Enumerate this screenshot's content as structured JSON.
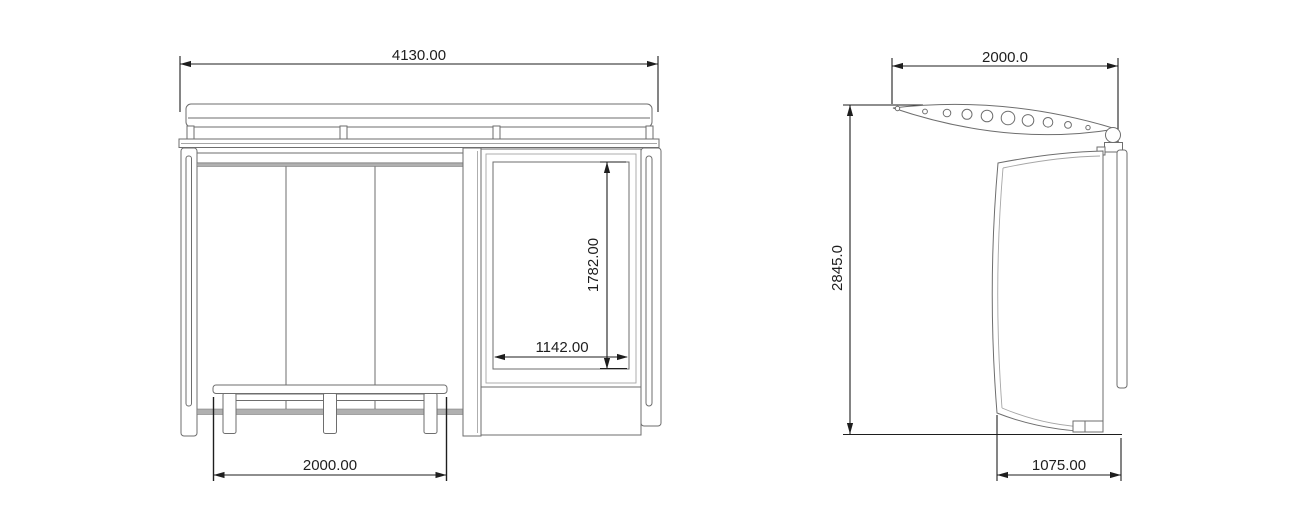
{
  "colors": {
    "bg": "#ffffff",
    "line": "#6e6e6e",
    "line_light": "#a6a6a6",
    "band": "#b0b0b0",
    "dim": "#1e1e1e"
  },
  "drawing": {
    "views": {
      "front": {
        "dims": {
          "overall_width": "4130.00",
          "ad_panel_height": "1782.00",
          "ad_panel_width": "1142.00",
          "bench_length": "2000.00"
        }
      },
      "side": {
        "dims": {
          "roof_depth": "2000.0",
          "overall_height": "2845.0",
          "base_depth": "1075.00"
        }
      }
    }
  }
}
